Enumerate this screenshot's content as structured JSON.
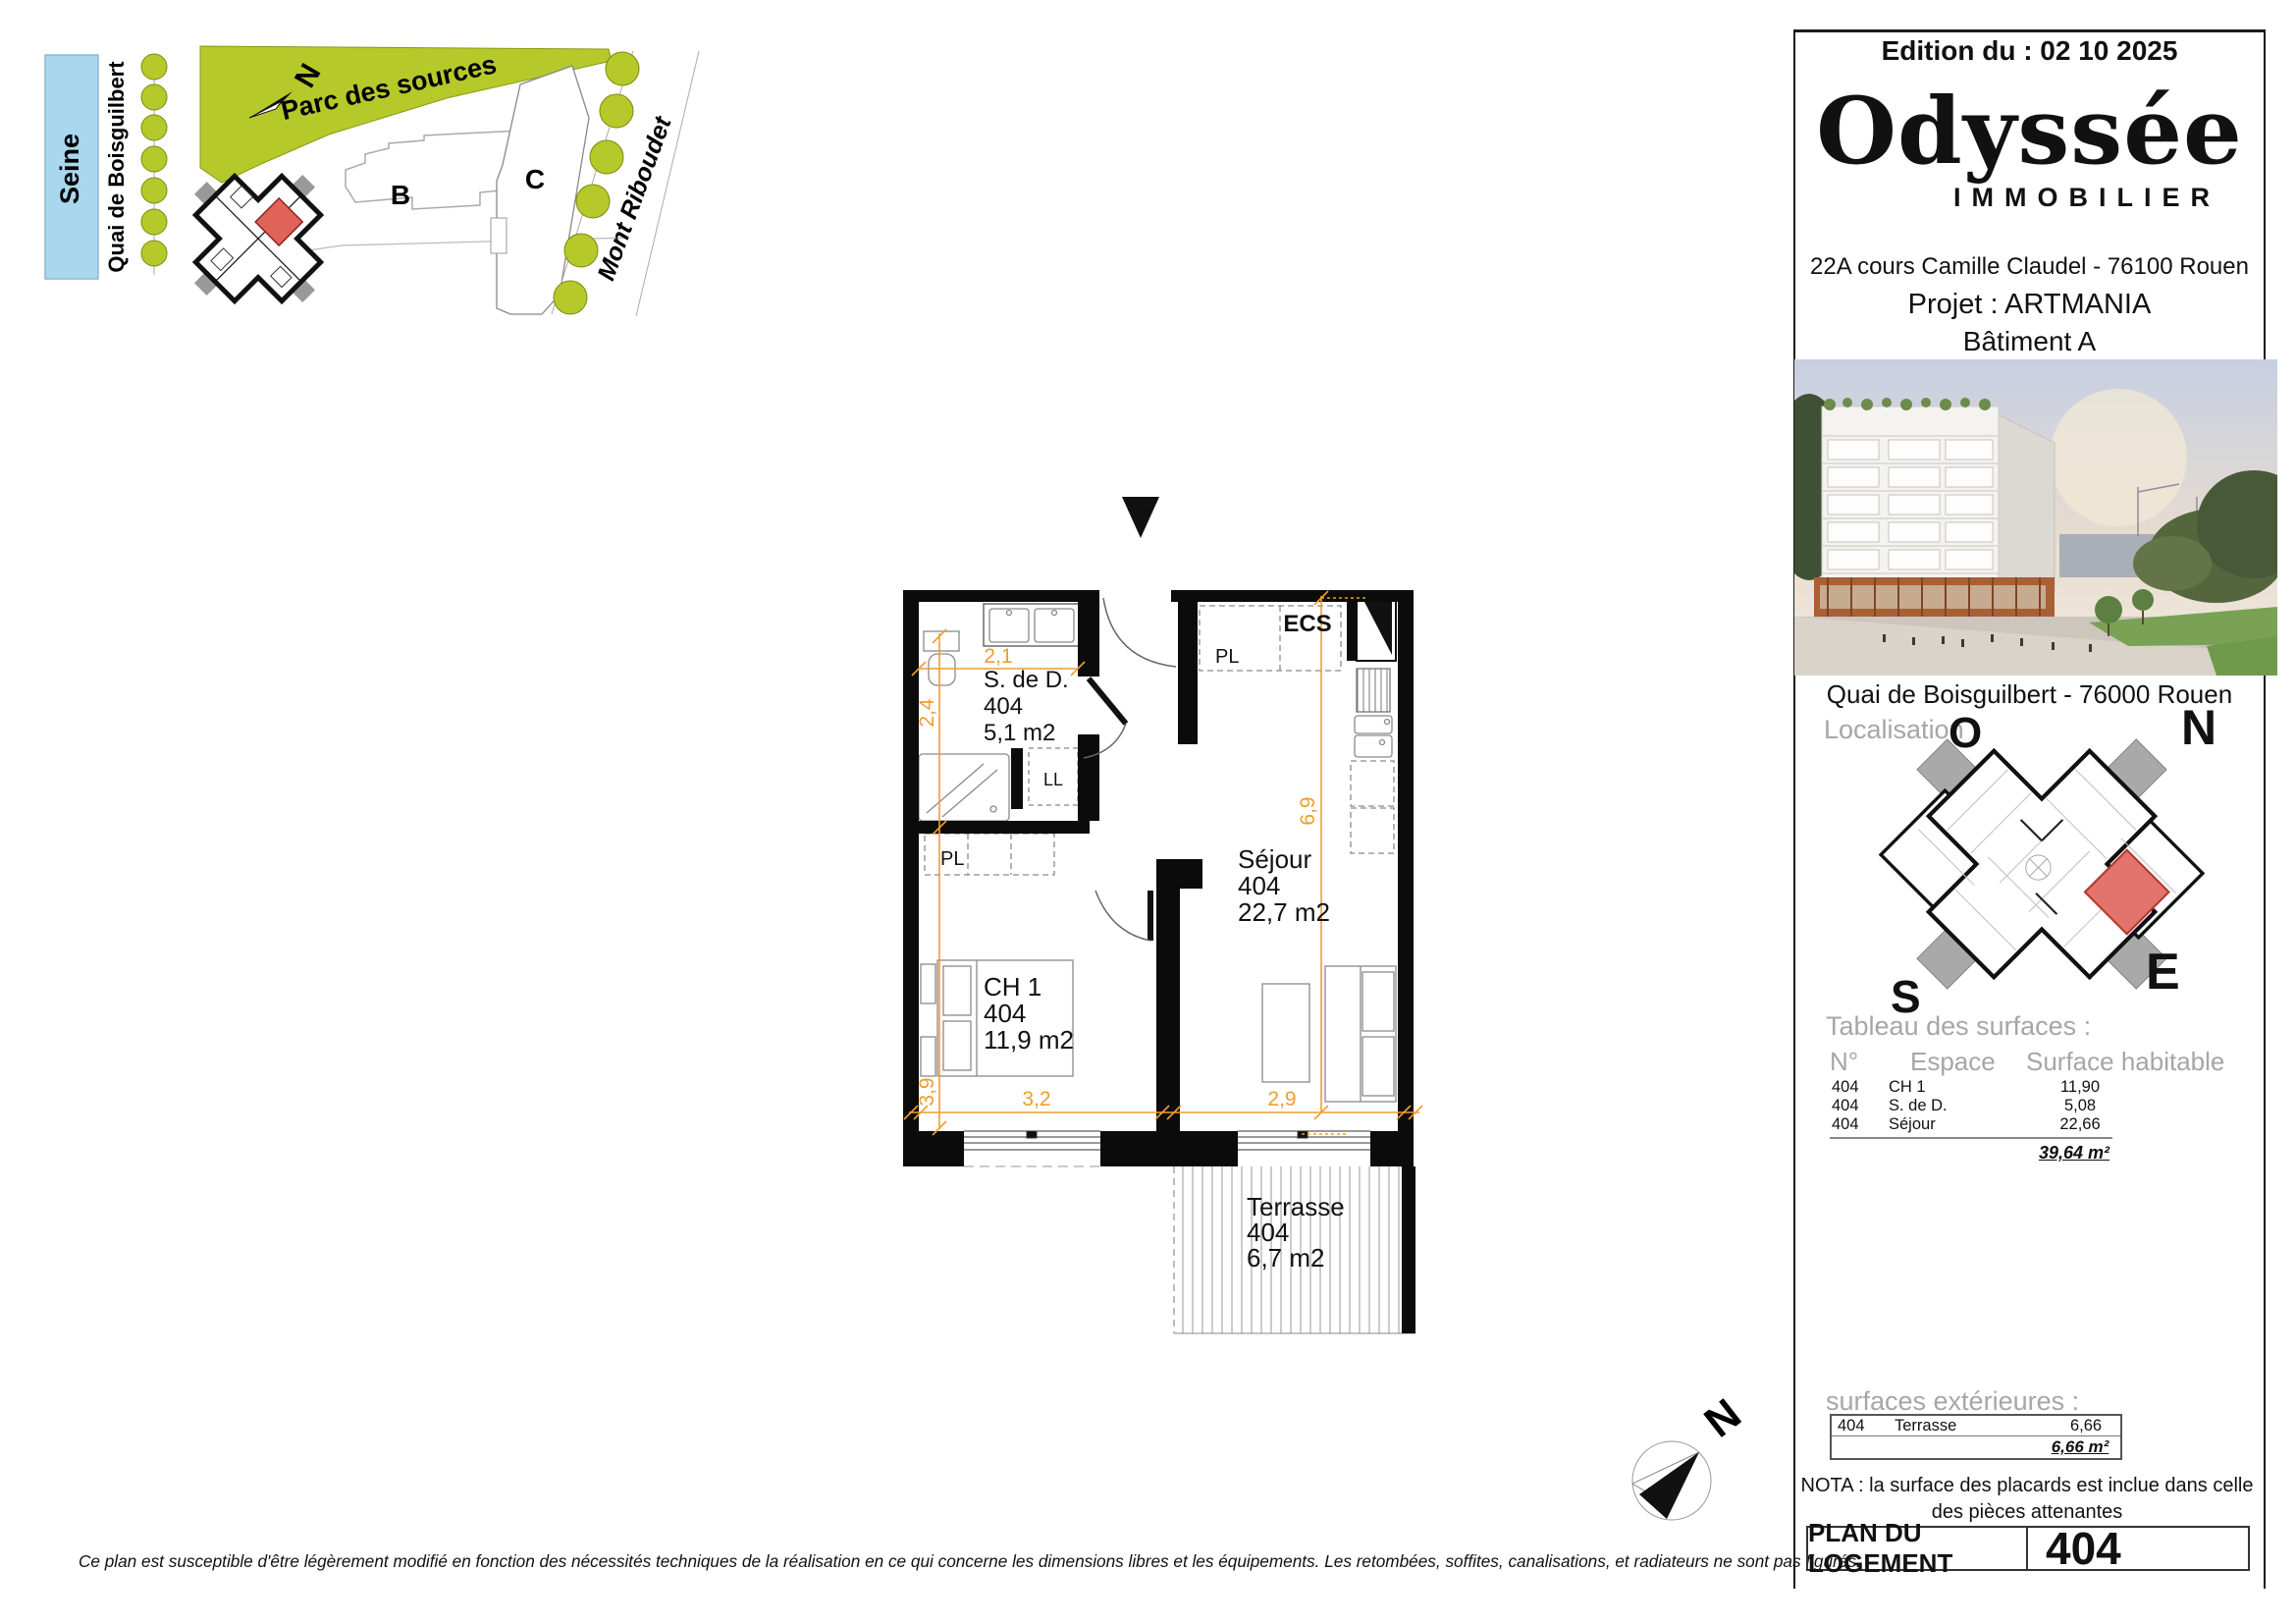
{
  "edition": "Edition du : 02 10 2025",
  "logo": {
    "name": "Odyssée",
    "sub": "IMMOBILIER"
  },
  "address": "22A cours Camille Claudel - 76100 Rouen",
  "project": "Projet : ARTMANIA",
  "building": "Bâtiment A",
  "photo_caption": "Quai de Boisguilbert - 76000 Rouen",
  "localisation": {
    "label": "Localisation :",
    "n": "N",
    "o": "O",
    "s": "S",
    "e": "E"
  },
  "surfaces": {
    "title": "Tableau des surfaces :",
    "col_num": "N°",
    "col_space": "Espace",
    "col_area": "Surface habitable",
    "rows": [
      {
        "num": "404",
        "space": "CH 1",
        "area": "11,90"
      },
      {
        "num": "404",
        "space": "S. de D.",
        "area": "5,08"
      },
      {
        "num": "404",
        "space": "Séjour",
        "area": "22,66"
      }
    ],
    "total": "39,64 m²"
  },
  "exterior": {
    "title": "surfaces extérieures :",
    "rows": [
      {
        "num": "404",
        "space": "Terrasse",
        "area": "6,66"
      }
    ],
    "total": "6,66 m²"
  },
  "nota_line1": "NOTA : la surface des placards est inclue dans celle",
  "nota_line2": "des pièces attenantes",
  "footer": {
    "label": "PLAN DU LOGEMENT",
    "number": "404"
  },
  "sitemap": {
    "seine": "Seine",
    "quai": "Quai de Boisguilbert",
    "parc": "Parc des sources",
    "mont": "Mont Riboudet",
    "bat_b": "B",
    "bat_c": "C",
    "north": "N"
  },
  "floorplan": {
    "rooms": {
      "sdd": {
        "name": "S. de D.",
        "num": "404",
        "area": "5,1 m2"
      },
      "sejour": {
        "name": "Séjour",
        "num": "404",
        "area": "22,7 m2"
      },
      "ch1": {
        "name": "CH 1",
        "num": "404",
        "area": "11,9 m2"
      },
      "terrasse": {
        "name": "Terrasse",
        "num": "404",
        "area": "6,7 m2"
      }
    },
    "labels": {
      "ecs": "ECS",
      "pl": "PL",
      "ll": "LL"
    },
    "dims": {
      "w_sdd": "2,1",
      "h_sdd": "2,4",
      "h_sejour": "6,9",
      "h_ch1": "3,9",
      "w_ch1": "3,2",
      "w_sejour": "2,9"
    },
    "north": "N"
  },
  "disclaimer": "Ce plan est susceptible d'être légèrement modifié en fonction des nécessités techniques de la réalisation en ce qui concerne les dimensions libres et les équipements. Les retombées, soffites, canalisations, et radiateurs ne sont pas figurés.",
  "colors": {
    "dimension_orange": "#ee9e2c",
    "park_green": "#b5c92a",
    "seine_blue": "#a9d7ee",
    "unit_red": "#e0635a",
    "grey_text": "#a6a6a6"
  }
}
